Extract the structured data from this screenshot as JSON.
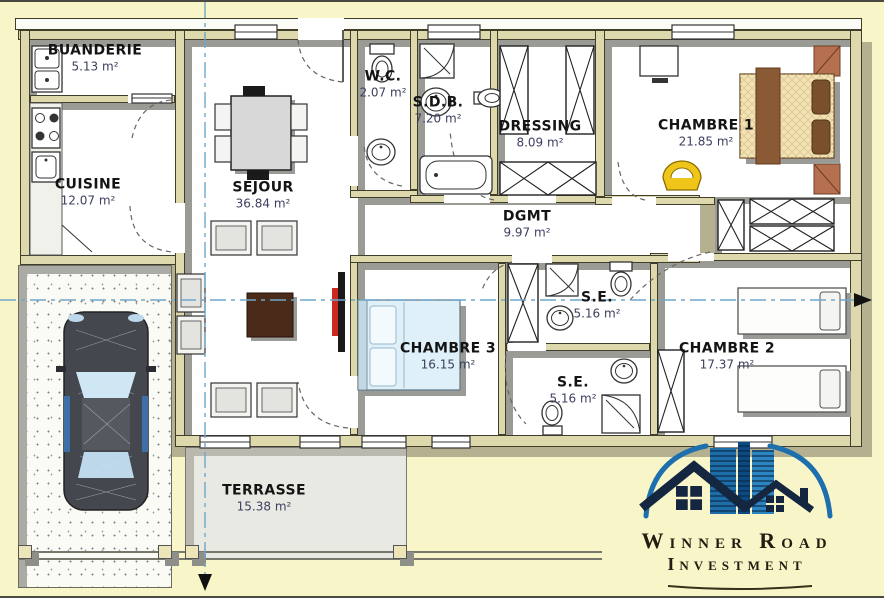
{
  "plan": {
    "rooms": [
      {
        "key": "buanderie",
        "name": "BUANDERIE",
        "area": "5.13 m²"
      },
      {
        "key": "cuisine",
        "name": "CUISINE",
        "area": "12.07 m²"
      },
      {
        "key": "sejour",
        "name": "SEJOUR",
        "area": "36.84 m²"
      },
      {
        "key": "wc",
        "name": "W.C.",
        "area": "2.07 m²"
      },
      {
        "key": "sdb",
        "name": "S.D.B.",
        "area": "7.20 m²"
      },
      {
        "key": "dressing",
        "name": "DRESSING",
        "area": "8.09 m²"
      },
      {
        "key": "chambre1",
        "name": "CHAMBRE 1",
        "area": "21.85 m²"
      },
      {
        "key": "dgmt",
        "name": "DGMT",
        "area": "9.97 m²"
      },
      {
        "key": "se_haut",
        "name": "S.E.",
        "area": "5.16 m²"
      },
      {
        "key": "chambre3",
        "name": "CHAMBRE 3",
        "area": "16.15 m²"
      },
      {
        "key": "se_bas",
        "name": "S.E.",
        "area": "5.16 m²"
      },
      {
        "key": "chambre2",
        "name": "CHAMBRE 2",
        "area": "17.37 m²"
      },
      {
        "key": "terrasse",
        "name": "TERRASSE",
        "area": "15.38 m²"
      }
    ]
  },
  "logo": {
    "line1": "Winner Road",
    "line2": "Investment"
  },
  "colors": {
    "bg": "#F8F6C8",
    "wall": "#DED9AC",
    "shadow": "#9B9B96",
    "extShadow": "#B5B190",
    "centerline": "#6FA7CC",
    "terrace": "#E9E9E3",
    "coffee": "#4A2A18",
    "tvRed": "#CC2A1E",
    "chairYellow": "#F0C519",
    "bedTan": "#F2E2B4",
    "runner": "#8A5A34",
    "bedBlue": "#DFF0F8",
    "logoBlue": "#1E6FAE",
    "logoDark": "#152740"
  }
}
